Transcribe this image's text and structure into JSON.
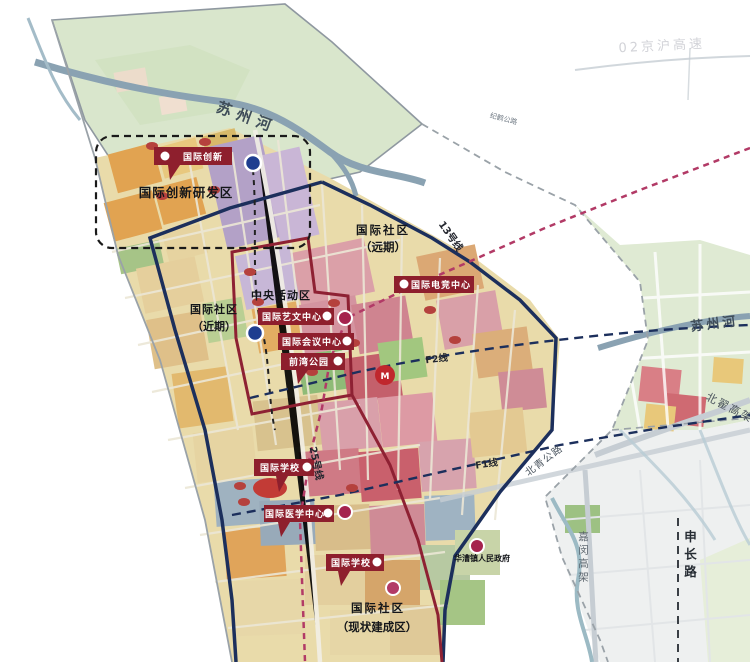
{
  "map": {
    "rivers": {
      "suzhou_top": "苏州河",
      "suzhou_right": "苏州河"
    },
    "roads": {
      "jinghu": "02京沪高速",
      "jihe": "纪鹤公路",
      "beidi": "北翟高架",
      "beiqing": "北青公路",
      "jiamin": "嘉闵高架",
      "shenchang": "申长路"
    },
    "transit": {
      "line13": "13号线",
      "line25": "25号线",
      "f1": "F1线",
      "f2": "F2线",
      "metro_mark": "M"
    },
    "districts": {
      "innovation": "国际创新研发区",
      "community_far_l1": "国际社区",
      "community_far_l2": "（远期）",
      "community_near_l1": "国际社区",
      "community_near_l2": "（近期）",
      "cbd": "中央活动区",
      "community_built_l1": "国际社区",
      "community_built_l2": "（现状建成区）",
      "government": "华漕镇人民政府"
    },
    "badges": {
      "innovation": "国际创新",
      "esports": "国际电竞中心",
      "arts": "国际艺文中心",
      "conference": "国际会议中心",
      "park": "前湾公园",
      "school_north": "国际学校",
      "medical": "国际医学中心",
      "school_south": "国际学校"
    },
    "colors": {
      "badge_bg": "#8e1f2d",
      "boundary_navy": "#1c2f5c",
      "boundary_maroon": "#8e2133",
      "metro_magenta": "#b23a66",
      "river": "#8aa2b2"
    }
  }
}
